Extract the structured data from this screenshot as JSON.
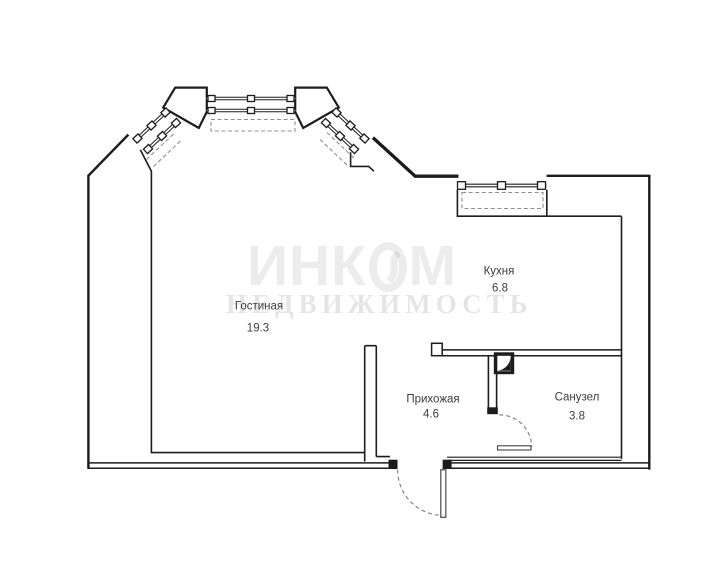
{
  "title": "apartment-floor-plan",
  "watermark": {
    "brand": "ИНКОМ",
    "brand_left": "ИНК",
    "brand_right": "М",
    "subtitle": "НЕДВИЖИМОСТЬ"
  },
  "rooms": [
    {
      "name": "Гостиная",
      "area": "19.3"
    },
    {
      "name": "Кухня",
      "area": "6.8"
    },
    {
      "name": "Прихожая",
      "area": "4.6"
    },
    {
      "name": "Санузел",
      "area": "3.8"
    }
  ],
  "colors": {
    "walls": "#1c1c1c",
    "dashed": "#8f8f8f",
    "label_text": "#3c3c3c",
    "background": "#ffffff"
  },
  "features": [
    "bay-window-with-two-angled-windows",
    "kitchen-window",
    "entrance-door-swing",
    "bathroom-door-swing",
    "vent-shaft"
  ]
}
